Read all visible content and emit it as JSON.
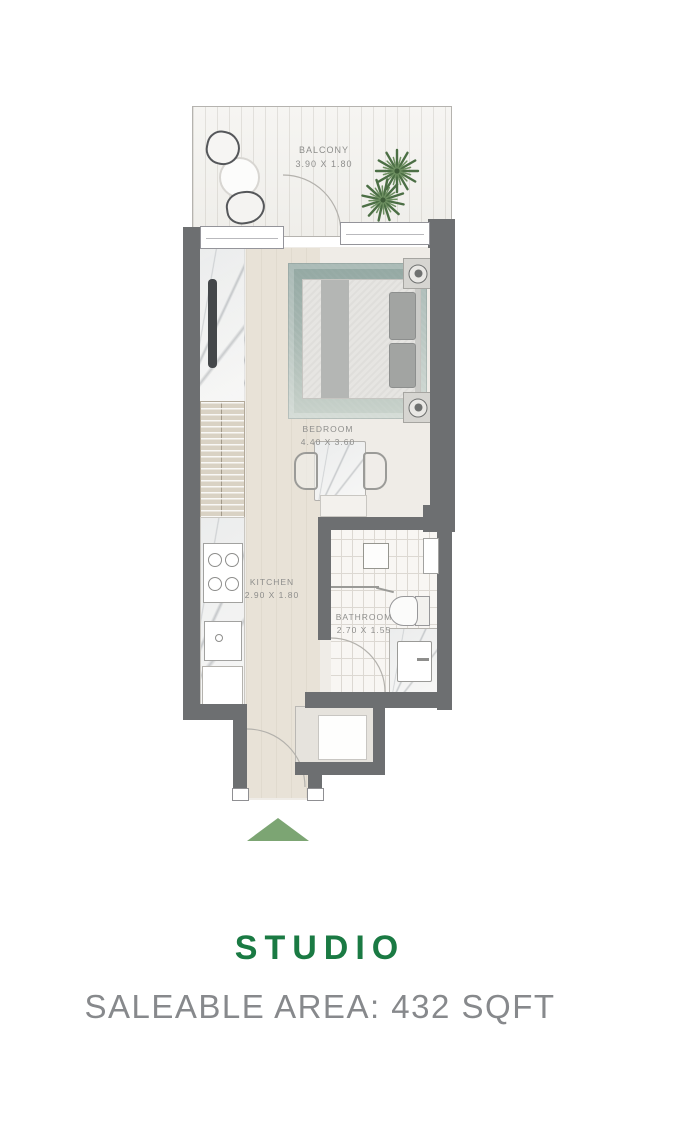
{
  "colors": {
    "wall": "#6d6f71",
    "floor": "#efece7",
    "corridor": "#e8e2d7",
    "rug": "#a7b7b1",
    "green-accent": "#7ca573",
    "title-green": "#1a7a43",
    "subtitle-gray": "#87898c",
    "label-gray": "#8e8e8c"
  },
  "plan": {
    "balcony": {
      "name": "BALCONY",
      "dims": "3.90 X 1.80"
    },
    "bedroom": {
      "name": "BEDROOM",
      "dims": "4.40 X 3.60"
    },
    "kitchen": {
      "name": "KITCHEN",
      "dims": "2.90 X 1.80"
    },
    "bathroom": {
      "name": "BATHROOM",
      "dims": "2.70 X 1.55"
    }
  },
  "footer": {
    "title": "STUDIO",
    "subtitle": "SALEABLE AREA: 432 SQFT"
  }
}
